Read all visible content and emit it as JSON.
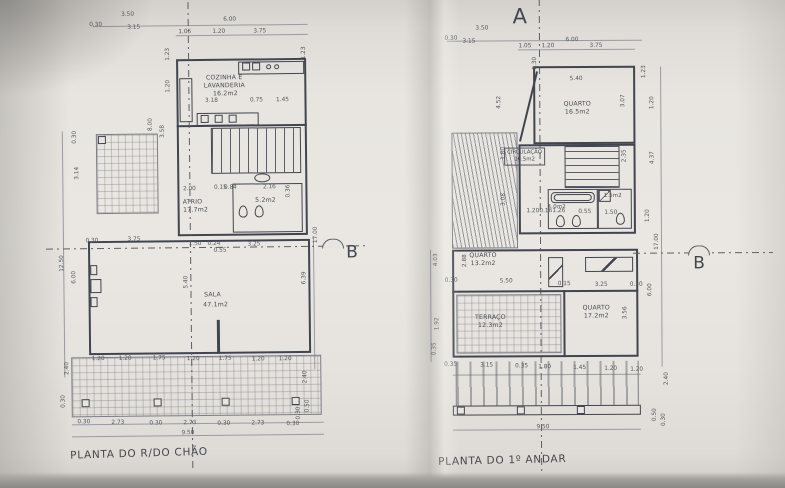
{
  "markers": {
    "a": "A",
    "b_left": "B",
    "b_right": "B"
  },
  "plan_left": {
    "title": "PLANTA DO R/DO CHÃO",
    "rooms": {
      "kitchen_line1": "COZINHA E",
      "kitchen_line2": "LAVANDERIA",
      "kitchen_area": "16.2m2",
      "atrium_name": "ATRIO",
      "atrium_area": "17.7m2",
      "bath_area": "5.2m2",
      "living_name": "SALA",
      "living_area": "47.1m2"
    },
    "dims": [
      "3.50",
      "0.30",
      "3.15",
      "6.00",
      "1.05",
      "1.20",
      "3.75",
      "1.23",
      "1.20",
      "3.18",
      "0.75",
      "1.45",
      "1.23",
      "8.00",
      "3.58",
      "0.30",
      "3.14",
      "2.00",
      "0.15",
      "0.84",
      "2.16",
      "0.36",
      "0.30",
      "3.75",
      "1.50",
      "0.24",
      "3.25",
      "0.55",
      "5.40",
      "12.50",
      "6.00",
      "6.39",
      "17.00",
      "2.40",
      "1.20",
      "1.20",
      "1.75",
      "1.20",
      "1.75",
      "1.20",
      "1.20",
      "0.30",
      "2.73",
      "0.30",
      "2.73",
      "0.30",
      "2.73",
      "0.30",
      "9.50",
      "2.40",
      "0.50",
      "0.30",
      "0.30"
    ]
  },
  "plan_right": {
    "title": "PLANTA DO 1º ANDAR",
    "rooms": {
      "bedroom1_name": "QUARTO",
      "bedroom1_area": "16.5m2",
      "circulation_name": "CIRCULAÇÃO",
      "circulation_area": "10.5m2",
      "bath_area": "4.0m2",
      "wc_area": "1.5m2",
      "bedroom2_name": "QUARTO",
      "bedroom2_area": "13.2m2",
      "terrace_name": "TERRAÇO",
      "terrace_area": "12.3m2",
      "bedroom3_name": "QUARTO",
      "bedroom3_area": "17.2m2"
    },
    "dims": [
      "3.50",
      "0.30",
      "3.15",
      "6.00",
      "1.05",
      "1.20",
      "3.75",
      "5.40",
      "0.30",
      "1.23",
      "1.20",
      "3.07",
      "4.52",
      "1.80",
      "2.35",
      "4.37",
      "1.20",
      "17.00",
      "1.20",
      "0.16",
      "1.26",
      "0.55",
      "1.50",
      "4.03",
      "2.88",
      "0.30",
      "5.50",
      "3.08",
      "1.92",
      "0.35",
      "0.15",
      "3.25",
      "0.30",
      "3.56",
      "6.00",
      "0.35",
      "3.15",
      "0.35",
      "1.80",
      "1.45",
      "1.20",
      "1.20",
      "9.50",
      "2.40",
      "0.50",
      "0.30"
    ]
  }
}
